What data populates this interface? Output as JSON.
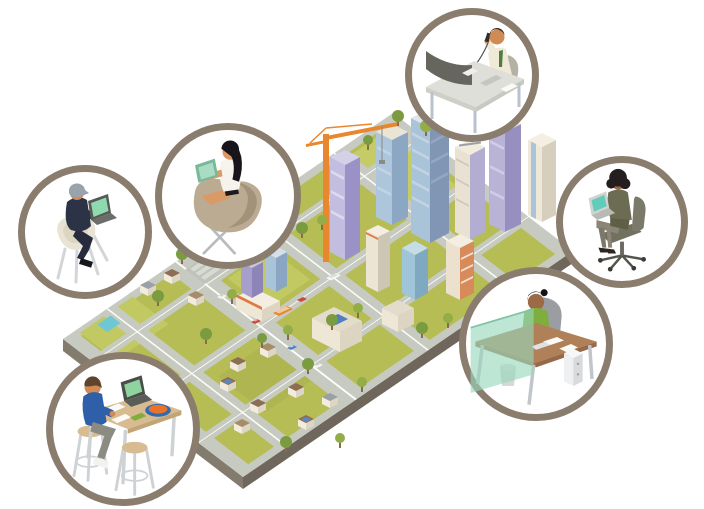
{
  "page": {
    "background": "#ffffff",
    "kind": "isometric-remote-work-illustration"
  },
  "palette": {
    "circle_border": "#8b7d6d",
    "grass": "#b6bd55",
    "grass_light": "#c5cb66",
    "road": "#c6cac1",
    "road_line": "#fdfdf8",
    "slab_side": "#837b6e",
    "slab_side_dark": "#6f675c",
    "building_cream": "#ece5d6",
    "building_cream_shade": "#d6cfbd",
    "building_blue": "#a9c3d9",
    "building_blue_shade": "#8195b5",
    "building_purple": "#b9b3d6",
    "building_purple_shade": "#948cc0",
    "crane_orange": "#e8872e",
    "accent_orange": "#e07840",
    "tree_green": "#7b9b40",
    "tree_green_light": "#93ad49",
    "pool_teal": "#6fc7d4",
    "screen_mint": "#8fd9ae",
    "screen_teal": "#62ccba",
    "privacy_panel_green": "#96d6ba",
    "desk_wood": "#b08058",
    "table_tan": "#d8bb90",
    "skin": "#d08a54",
    "skin_dark": "#9c6b45",
    "shirt_navy": "#2d3347",
    "shirt_blue": "#2f5fa8",
    "top_green": "#7fae3f",
    "jacket_olive": "#6c6c52",
    "bowl_blue": "#2f6bb0",
    "bowl_fill_orange": "#e8742c"
  },
  "city": {
    "name": "isometric-city",
    "districts": [
      "downtown-towers",
      "construction-site-crane",
      "midtown-offices",
      "strip-mall",
      "suburban-houses",
      "parks-and-pools"
    ]
  },
  "vignettes": [
    {
      "id": "executive-on-phone",
      "position": "top",
      "scene": "man on phone at desk with curved monitor"
    },
    {
      "id": "casual-laptop-worker",
      "position": "upper-left",
      "scene": "man with cap seated with laptop"
    },
    {
      "id": "egg-chair-worker",
      "position": "left",
      "scene": "woman in egg chair with tablet"
    },
    {
      "id": "office-chair-worker",
      "position": "right",
      "scene": "woman on swivel chair with laptop"
    },
    {
      "id": "desk-worker",
      "position": "lower-right",
      "scene": "woman at desk behind green privacy screen"
    },
    {
      "id": "cafe-table-worker",
      "position": "lower-left",
      "scene": "person at high table with laptop and bowl"
    }
  ]
}
